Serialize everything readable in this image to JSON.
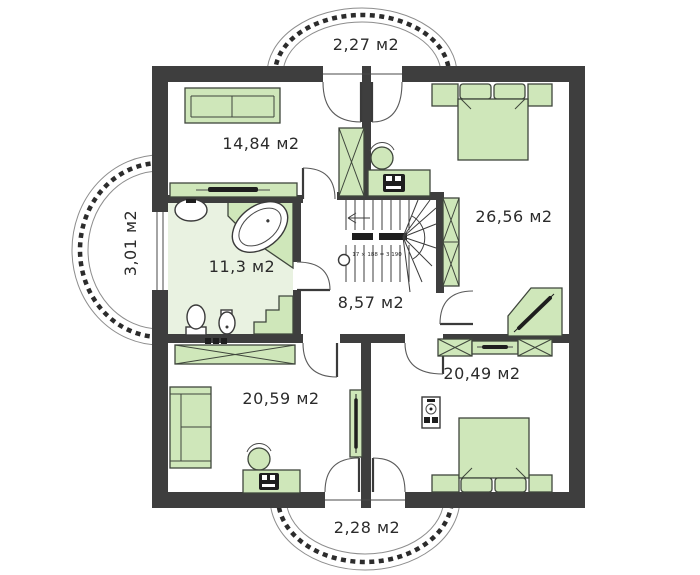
{
  "colors": {
    "wall": "#3e3e3e",
    "furn": "#cfe7ba",
    "furn_stroke": "#3f463c",
    "bath_floor": "#e9f2e1",
    "label": "#2b2b2b"
  },
  "labels": {
    "balcony_top": "2,27 м2",
    "bedroom_top_left": "14,84 м2",
    "bedroom_top_right": "26,56 м2",
    "balcony_left": "3,01 м2",
    "bathroom": "11,3 м2",
    "hallway": "8,57 м2",
    "bedroom_bottom_left": "20,59 м2",
    "bedroom_bottom_right": "20,49 м2",
    "balcony_bottom": "2,28 м2",
    "stair_note": "17 × 188 = 3 190"
  },
  "rooms": [
    {
      "id": "balcony-top",
      "area_label": "2,27 м2",
      "type": "balcony"
    },
    {
      "id": "bedroom-top-left",
      "area_label": "14,84 м2",
      "furniture": [
        "sofa",
        "sliding-wardrobe",
        "wardrobe"
      ]
    },
    {
      "id": "bedroom-top-right",
      "area_label": "26,56 м2",
      "furniture": [
        "double-bed",
        "nightstands",
        "wardrobe",
        "desk",
        "chair",
        "corner-desk"
      ]
    },
    {
      "id": "balcony-left",
      "area_label": "3,01 м2",
      "type": "balcony"
    },
    {
      "id": "bathroom",
      "area_label": "11,3 м2",
      "furniture": [
        "sink",
        "bathtub",
        "toilet",
        "bidet",
        "step"
      ]
    },
    {
      "id": "hallway",
      "area_label": "8,57 м2",
      "furniture": [
        "staircase"
      ]
    },
    {
      "id": "bedroom-bottom-left",
      "area_label": "20,59 м2",
      "furniture": [
        "sofa",
        "wardrobe",
        "desk",
        "chair",
        "mirror"
      ]
    },
    {
      "id": "bedroom-bottom-right",
      "area_label": "20,49 м2",
      "furniture": [
        "double-bed",
        "nightstands",
        "wardrobes",
        "dresser",
        "audio-unit"
      ]
    },
    {
      "id": "balcony-bottom",
      "area_label": "2,28 м2",
      "type": "balcony"
    }
  ],
  "stairs": {
    "note": "17 × 188 = 3 190",
    "direction": "up"
  }
}
